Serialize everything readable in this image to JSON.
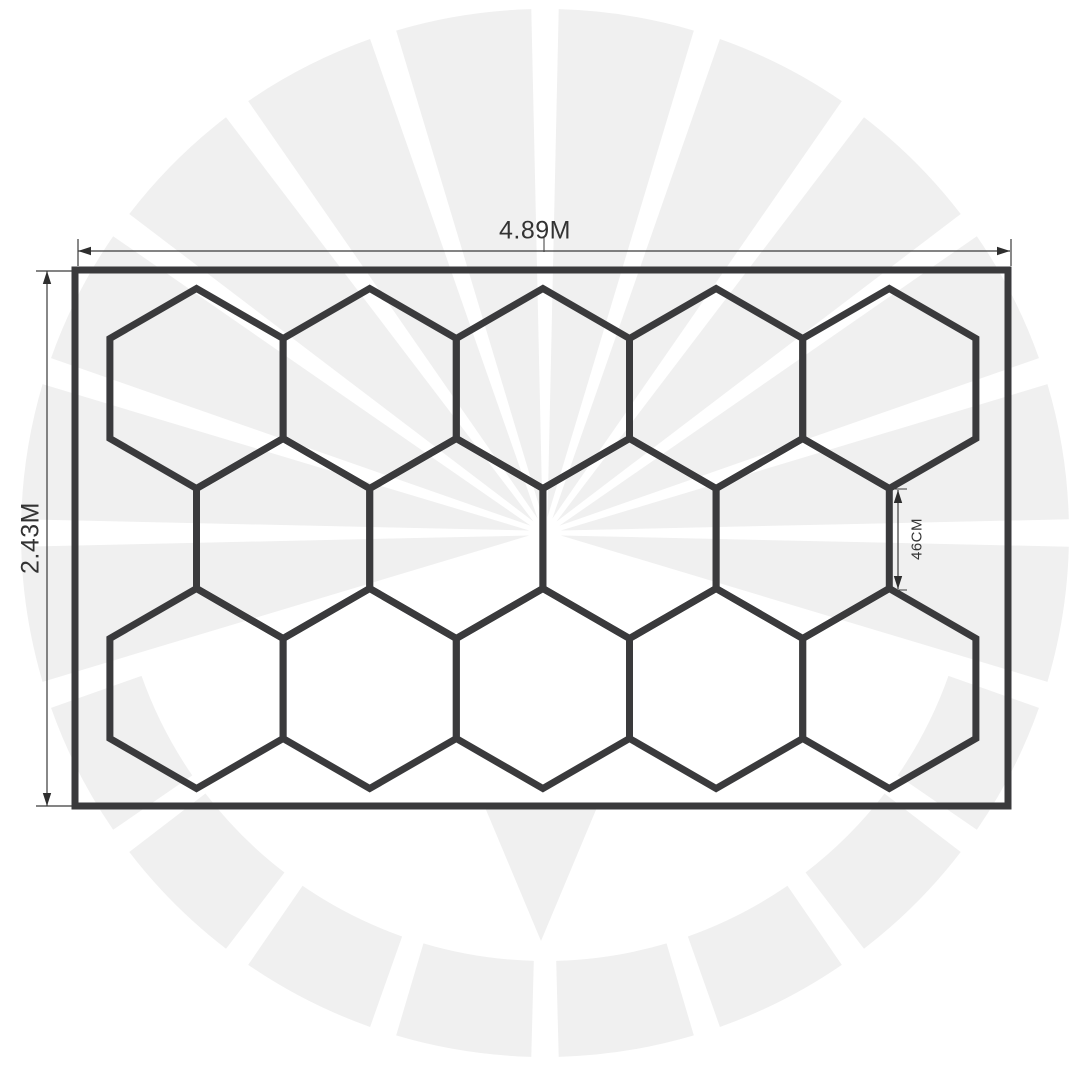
{
  "diagram": {
    "labels": {
      "width": "4.89M",
      "height": "2.43M",
      "hex_side": "46CM"
    },
    "colors": {
      "line": "#3a3a3c",
      "dimension_line": "#3a3a3a",
      "dimension_fill": "#2e2e2e",
      "text": "#333333",
      "watermark": "#f0f0f0",
      "background": "#ffffff"
    },
    "border_rect": {
      "x": 75,
      "y": 270,
      "width": 933,
      "height": 536,
      "stroke_width": 7
    },
    "hex_grid": {
      "side": 100,
      "rows": [
        {
          "cy": 388.5,
          "cx": [
            196.5,
            369.7,
            542.9,
            716.1,
            889.3
          ]
        },
        {
          "cy": 538.5,
          "cx": [
            283.1,
            456.3,
            629.5,
            802.7
          ]
        },
        {
          "cy": 688.5,
          "cx": [
            196.5,
            369.7,
            542.9,
            716.1,
            889.3
          ]
        }
      ],
      "hex_count": 14
    },
    "dimensions": {
      "width": {
        "line_y": 251,
        "x1": 78,
        "x2": 1010,
        "tick_y1": 239,
        "tick_y2": 266,
        "center_tick_x": 544
      },
      "height": {
        "line_x": 47,
        "y1": 271,
        "y2": 806,
        "tick_x1": 36,
        "tick_x2": 72
      },
      "hex_side": {
        "line_x": 898,
        "y1": 490,
        "y2": 589,
        "tick_x1": 890,
        "tick_x2": 907
      }
    },
    "watermark": {
      "cx": 545,
      "cy": 533,
      "r_outer": 524,
      "r_inner_ring": 428,
      "fan": {
        "start_deg": -18,
        "step_deg": 18,
        "count": 12,
        "gap_deg": 3,
        "r_hub": 16
      },
      "ring": {
        "start_deg": -162,
        "step_deg": 18,
        "count": 8,
        "gap_deg": 3
      },
      "v_wedge": [
        [
          484,
          805
        ],
        [
          598,
          805
        ],
        [
          541,
          941
        ]
      ]
    }
  }
}
